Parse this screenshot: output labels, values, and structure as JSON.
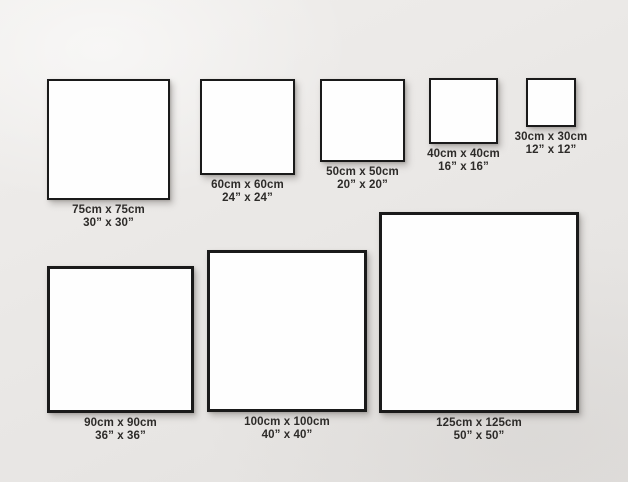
{
  "diagram": {
    "description": "Square canvas print size comparison chart on a wall",
    "wall_color": "#e9e7e5",
    "frame_border_color": "#1a1a1a",
    "frame_fill_color": "#fefefe",
    "label_text_color": "#2d2b29"
  },
  "frames": [
    {
      "cm_label": "75cm x 75cm",
      "inch_label": "30” x 30”",
      "box": {
        "left": 47,
        "top": 79,
        "width": 123,
        "height": 121,
        "border": 2
      }
    },
    {
      "cm_label": "60cm x 60cm",
      "inch_label": "24” x 24”",
      "box": {
        "left": 200,
        "top": 79,
        "width": 95,
        "height": 96,
        "border": 2
      }
    },
    {
      "cm_label": "50cm x 50cm",
      "inch_label": "20” x 20”",
      "box": {
        "left": 320,
        "top": 79,
        "width": 85,
        "height": 83,
        "border": 2
      }
    },
    {
      "cm_label": "40cm x 40cm",
      "inch_label": "16” x 16”",
      "box": {
        "left": 429,
        "top": 78,
        "width": 69,
        "height": 66,
        "border": 2
      }
    },
    {
      "cm_label": "30cm x 30cm",
      "inch_label": "12” x 12”",
      "box": {
        "left": 526,
        "top": 78,
        "width": 50,
        "height": 49,
        "border": 2
      }
    },
    {
      "cm_label": "90cm x 90cm",
      "inch_label": "36” x 36”",
      "box": {
        "left": 47,
        "top": 266,
        "width": 147,
        "height": 147,
        "border": 3
      }
    },
    {
      "cm_label": "100cm x 100cm",
      "inch_label": "40” x 40”",
      "box": {
        "left": 207,
        "top": 250,
        "width": 160,
        "height": 162,
        "border": 3
      }
    },
    {
      "cm_label": "125cm x 125cm",
      "inch_label": "50” x 50”",
      "box": {
        "left": 379,
        "top": 212,
        "width": 200,
        "height": 201,
        "border": 3
      }
    }
  ]
}
